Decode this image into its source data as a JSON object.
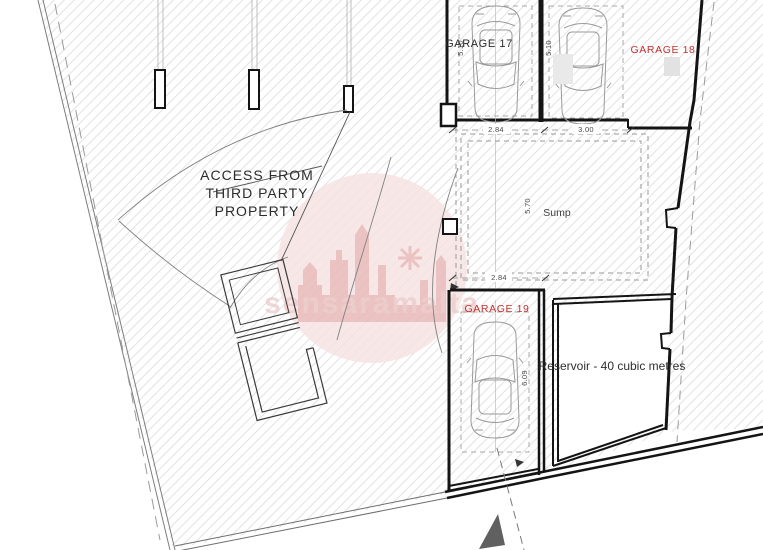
{
  "plan": {
    "access_note": {
      "line1": "ACCESS FROM",
      "line2": "THIRD PARTY",
      "line3": "PROPERTY"
    },
    "rooms": {
      "garage17": {
        "label": "GARAGE 17",
        "depth": "5.10",
        "width": "2.84"
      },
      "garage18": {
        "label": "GARAGE 18",
        "depth": "5.10",
        "width": "3.00"
      },
      "garage19": {
        "label": "GARAGE 19",
        "depth": "6.09"
      },
      "sump": {
        "label": "Sump",
        "depth": "5.70",
        "width": "2.84"
      },
      "reservoir": {
        "label": "Reservoir - 40 cubic metres"
      }
    },
    "watermark": {
      "text": "sensaramalta",
      "logo": "castle-skyline",
      "color": "#ecc7c7"
    },
    "colors": {
      "wall": "#141414",
      "red_label": "#c43131",
      "hatch": "#e2e2e2",
      "watermark_circle": "#f6e3e3",
      "watermark_castle": "#e9b9b9",
      "north_arrow": "#606060"
    }
  }
}
